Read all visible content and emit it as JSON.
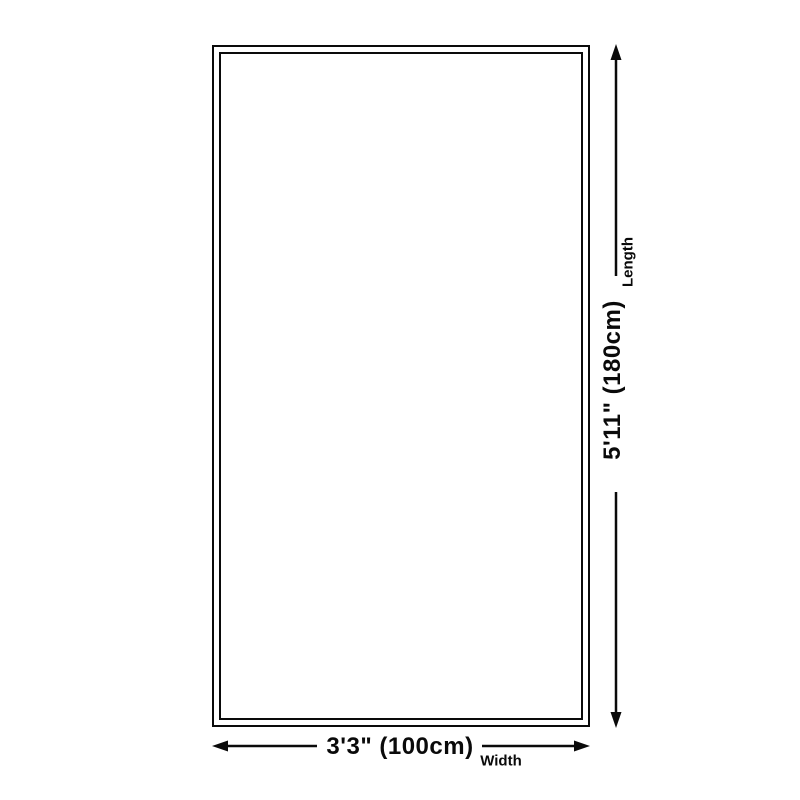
{
  "diagram": {
    "colors": {
      "background": "#ffffff",
      "line": "#0a0a0a",
      "text": "#0a0a0a"
    },
    "shape": {
      "kind": "rectangle",
      "border": "double-outline"
    },
    "length_dimension": {
      "value": "5'11\" (180cm)",
      "label": "Length",
      "icon": "double-headed-arrow-vertical"
    },
    "width_dimension": {
      "value": "3'3\" (100cm)",
      "label": "Width",
      "icon": "double-headed-arrow-horizontal"
    }
  }
}
